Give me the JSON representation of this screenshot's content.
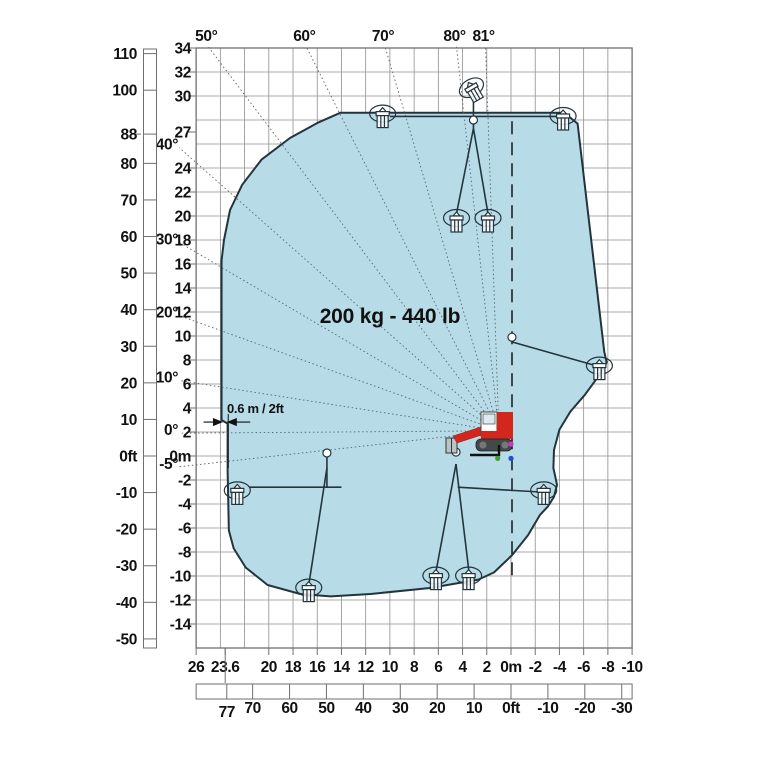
{
  "icons": {
    "machine": "tracked-boom-lift-icon",
    "platform": "work-basket-icon"
  },
  "colors": {
    "envelope_fill": "#b7dce8",
    "envelope_stroke": "#24343c",
    "grid": "#8f8f8f",
    "axis": "#6f6f6f",
    "text": "#111111",
    "ray": "#5a646a",
    "machine_red": "#d3271e",
    "dot_magenta": "#c837c8",
    "dot_green": "#3aa32f",
    "dot_blue": "#1f4fd8"
  },
  "chart_data": {
    "type": "area",
    "title": "Working envelope load chart",
    "capacity_label": "200 kg - 440 lb",
    "offset_annotation": "0.6 m / 2ft",
    "axes": {
      "x_range_m": [
        26,
        -10
      ],
      "y_range_m": [
        34,
        -16
      ],
      "grid_step_m": 2,
      "grid": true,
      "left_ft": {
        "ticks": [
          110,
          100,
          88,
          80,
          70,
          60,
          50,
          40,
          30,
          20,
          10,
          0,
          -10,
          -20,
          -30,
          -40,
          -50
        ],
        "zero_label": "0ft"
      },
      "left_m": {
        "ticks": [
          34,
          32,
          30,
          27,
          24,
          22,
          20,
          18,
          16,
          14,
          12,
          10,
          8,
          6,
          4,
          2,
          0,
          -2,
          -4,
          -6,
          -8,
          -10,
          -12,
          -14
        ],
        "zero_label": "0m"
      },
      "bottom_m": {
        "ticks": [
          26,
          23.6,
          20,
          18,
          16,
          14,
          12,
          10,
          8,
          6,
          4,
          2,
          0,
          -2,
          -4,
          -6,
          -8,
          -10
        ],
        "zero_label": "0m",
        "special_tick": 23.6
      },
      "bottom_ft": {
        "ticks": [
          77,
          70,
          60,
          50,
          40,
          30,
          20,
          10,
          0,
          -10,
          -20,
          -30
        ],
        "zero_label": "0ft",
        "special_tick": 77
      }
    },
    "boom_pivot_m": {
      "x": 1.0,
      "y": 2.1
    },
    "rotation_axis_line_m": {
      "x": 0,
      "from_y": 27.9,
      "to_y": -10.2
    },
    "angle_rays": [
      {
        "label": "50°",
        "end": [
          25.0,
          34.1
        ],
        "side": "top"
      },
      {
        "label": "60°",
        "end": [
          16.9,
          34.1
        ],
        "side": "top"
      },
      {
        "label": "70°",
        "end": [
          10.4,
          34.1
        ],
        "side": "top"
      },
      {
        "label": "80°",
        "end": [
          4.5,
          34.1
        ],
        "side": "top"
      },
      {
        "label": "81°",
        "end": [
          2.1,
          34.1
        ],
        "side": "top"
      },
      {
        "label": "40°",
        "end": [
          27.4,
          25.7
        ],
        "side": "left"
      },
      {
        "label": "30°",
        "end": [
          27.4,
          17.8
        ],
        "side": "left"
      },
      {
        "label": "20°",
        "end": [
          27.4,
          11.7
        ],
        "side": "left"
      },
      {
        "label": "10°",
        "end": [
          27.4,
          6.3
        ],
        "side": "left"
      },
      {
        "label": "0°",
        "end": [
          27.4,
          1.9
        ],
        "side": "left"
      },
      {
        "label": "-5°",
        "end": [
          27.4,
          -0.9
        ],
        "side": "left"
      }
    ],
    "envelope_m": [
      [
        14.1,
        28.6
      ],
      [
        -4.4,
        28.6
      ],
      [
        -5.5,
        27.7
      ],
      [
        -7.7,
        8.7
      ],
      [
        -7.9,
        7.8
      ],
      [
        -7.3,
        6.75
      ],
      [
        -6.1,
        5.1
      ],
      [
        -4.9,
        3.7
      ],
      [
        -4.0,
        2.2
      ],
      [
        -3.55,
        0.5
      ],
      [
        -3.5,
        -1.0
      ],
      [
        -3.8,
        -2.4
      ],
      [
        -3.55,
        -3.4
      ],
      [
        -3.05,
        -4.2
      ],
      [
        -2.4,
        -4.9
      ],
      [
        -1.4,
        -6.6
      ],
      [
        -0.1,
        -8.25
      ],
      [
        1.4,
        -9.7
      ],
      [
        2.7,
        -10.3
      ],
      [
        6.7,
        -11.0
      ],
      [
        11.6,
        -11.5
      ],
      [
        14.9,
        -11.7
      ],
      [
        17.4,
        -11.5
      ],
      [
        20.1,
        -10.75
      ],
      [
        21.9,
        -9.3
      ],
      [
        22.9,
        -7.7
      ],
      [
        23.3,
        -6.2
      ],
      [
        23.4,
        -1.2
      ],
      [
        23.4,
        2.7
      ],
      [
        23.9,
        3.0
      ],
      [
        23.9,
        16.3
      ],
      [
        23.7,
        18.0
      ],
      [
        23.2,
        20.5
      ],
      [
        22.2,
        22.6
      ],
      [
        20.6,
        24.7
      ],
      [
        18.25,
        26.5
      ],
      [
        15.9,
        27.8
      ]
    ],
    "platform_icons_m": [
      {
        "x": 10.6,
        "y": 28.2,
        "rot": 0
      },
      {
        "x": 3.1,
        "y": 30.4,
        "rot": -30
      },
      {
        "x": -4.3,
        "y": 28.0,
        "rot": 0
      },
      {
        "x": 4.5,
        "y": 19.5,
        "rot": 0
      },
      {
        "x": 1.9,
        "y": 19.5,
        "rot": 0
      },
      {
        "x": -7.3,
        "y": 7.2,
        "rot": 0
      },
      {
        "x": -2.7,
        "y": -3.2,
        "rot": 0
      },
      {
        "x": 22.6,
        "y": -3.2,
        "rot": 0
      },
      {
        "x": 16.7,
        "y": -11.3,
        "rot": 0
      },
      {
        "x": 6.2,
        "y": -10.3,
        "rot": 0
      },
      {
        "x": 3.5,
        "y": -10.3,
        "rot": 0
      }
    ],
    "boom_lines_m": [
      [
        [
          10.0,
          28.3
        ],
        [
          -4.5,
          28.3
        ]
      ],
      [
        [
          3.1,
          27.3
        ],
        [
          3.1,
          29.8
        ]
      ],
      [
        [
          3.1,
          27.3
        ],
        [
          4.5,
          20.2
        ]
      ],
      [
        [
          3.1,
          27.3
        ],
        [
          1.9,
          20.2
        ]
      ],
      [
        [
          -0.1,
          9.5
        ],
        [
          -7.1,
          7.5
        ]
      ],
      [
        [
          21.6,
          -2.6
        ],
        [
          14.0,
          -2.6
        ]
      ],
      [
        [
          15.2,
          -2.6
        ],
        [
          15.2,
          0.0
        ]
      ],
      [
        [
          15.2,
          -1.0
        ],
        [
          16.7,
          -10.75
        ]
      ],
      [
        [
          4.54,
          -0.67
        ],
        [
          6.2,
          -9.67
        ]
      ],
      [
        [
          4.54,
          -0.67
        ],
        [
          3.47,
          -9.67
        ]
      ],
      [
        [
          4.4,
          -2.6
        ],
        [
          -2.4,
          -3.0
        ]
      ]
    ],
    "joints_m": [
      {
        "x": 15.2,
        "y": 0.25
      },
      {
        "x": 4.54,
        "y": 0.33
      },
      {
        "x": -0.08,
        "y": 9.9
      },
      {
        "x": 3.1,
        "y": 28.0
      }
    ],
    "dimension_m": {
      "x1": 23.9,
      "x2": 23.35,
      "y": 2.83
    },
    "machine_dots_m": [
      {
        "x": 0.0,
        "y": 1.0,
        "color_key": "dot_magenta"
      },
      {
        "x": 1.1,
        "y": -0.2,
        "color_key": "dot_green"
      },
      {
        "x": 0.0,
        "y": -0.2,
        "color_key": "dot_blue"
      }
    ]
  }
}
